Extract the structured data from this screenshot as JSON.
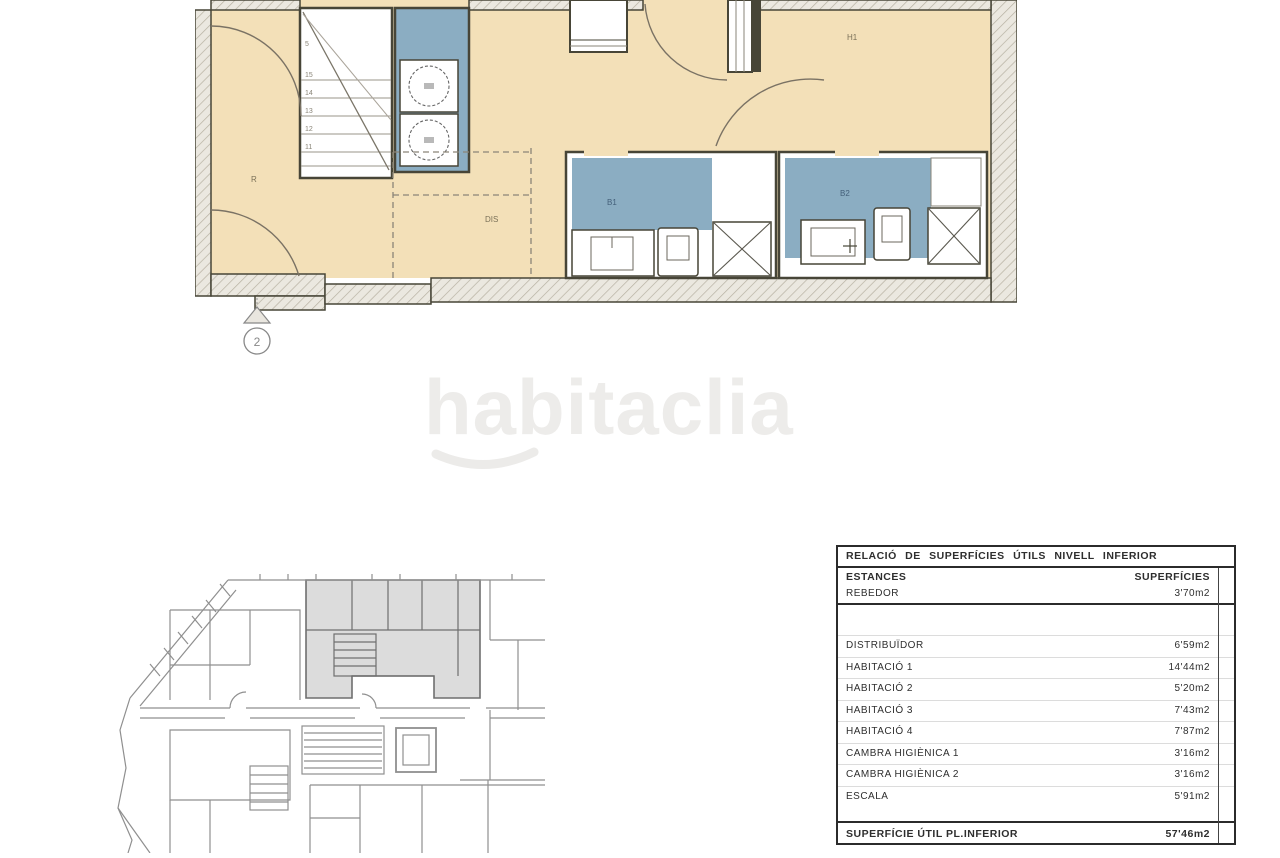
{
  "watermark": {
    "text": "habitaclia"
  },
  "plan": {
    "labels": {
      "rebedor": "R",
      "distribuidor": "DIS",
      "habitacio1": "H1",
      "bany1": "B1",
      "bany2": "B2"
    },
    "stairs": {
      "numbers": [
        "5",
        "15",
        "14",
        "13",
        "12",
        "11"
      ]
    },
    "section_marker": "2",
    "colors": {
      "floor": "#f3e0b8",
      "wet": "#8badc2",
      "wall": "#474537",
      "keyplan_highlight": "#dcdcdc"
    }
  },
  "table": {
    "title": "RELACIÓ DE SUPERFÍCIES ÚTILS NIVELL INFERIOR",
    "col_estances": "ESTANCES",
    "col_superficies": "SUPERFÍCIES",
    "rows": [
      {
        "label": "REBEDOR",
        "value": "3'70m2"
      },
      {
        "label": "DISTRIBUÏDOR",
        "value": "6'59m2"
      },
      {
        "label": "HABITACIÓ 1",
        "value": "14'44m2"
      },
      {
        "label": "HABITACIÓ 2",
        "value": "5'20m2"
      },
      {
        "label": "HABITACIÓ 3",
        "value": "7'43m2"
      },
      {
        "label": "HABITACIÓ 4",
        "value": "7'87m2"
      },
      {
        "label": "CAMBRA HIGIÈNICA 1",
        "value": "3'16m2"
      },
      {
        "label": "CAMBRA HIGIÈNICA 2",
        "value": "3'16m2"
      },
      {
        "label": "ESCALA",
        "value": "5'91m2"
      }
    ],
    "total_label": "SUPERFÍCIE ÚTIL PL.INFERIOR",
    "total_value": "57'46m2"
  }
}
